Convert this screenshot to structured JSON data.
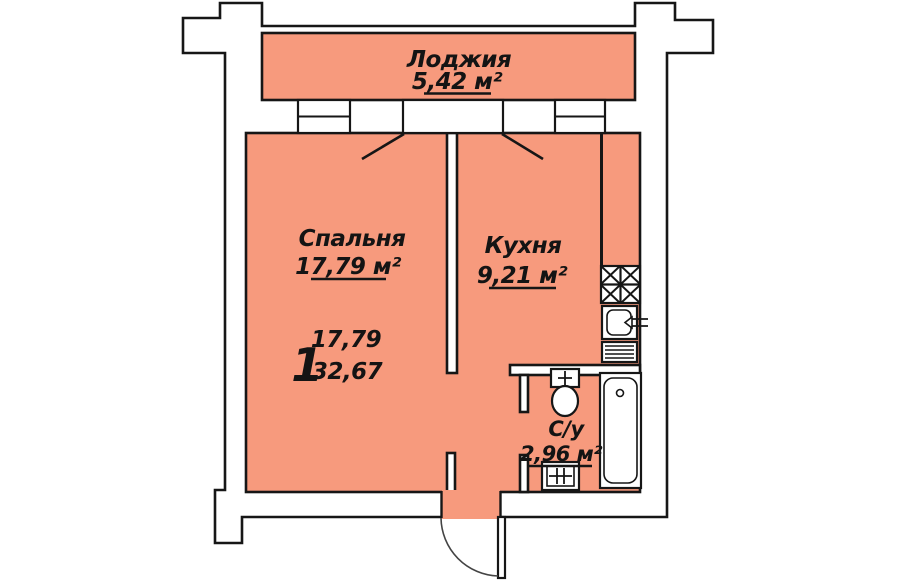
{
  "colors": {
    "room_fill": "#f79a7d",
    "wall_fill": "#ffffff",
    "line": "#161616",
    "page_bg": "#ffffff"
  },
  "plan": {
    "loggia": {
      "name": "Лоджия",
      "area": "5,42 м²"
    },
    "bedroom": {
      "name": "Спальня",
      "area": "17,79 м²"
    },
    "kitchen": {
      "name": "Кухня",
      "area": "9,21 м²"
    },
    "bathroom": {
      "name": "С/у",
      "area": "2,96 м²"
    },
    "stamp": {
      "rooms_count": "1",
      "living_area": "17,79",
      "total_area": "32,67"
    }
  }
}
